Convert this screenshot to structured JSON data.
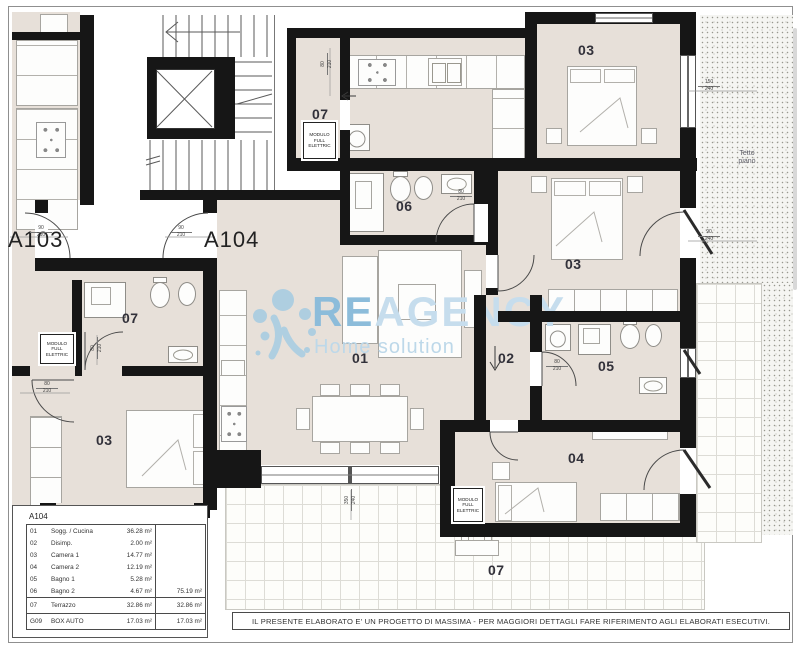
{
  "drawing": {
    "units": {
      "left": "A103",
      "main": "A104"
    },
    "room_labels": {
      "living": "01",
      "disimpegno": "02",
      "camera1": "03",
      "camera_top": "03",
      "camera_a103": "03",
      "camera2": "04",
      "bagno1": "05",
      "bagno2": "06",
      "balcony": "07",
      "bagno_a103": "07",
      "terrazzo": "07"
    },
    "annotations": {
      "tetto_line1": "Tetto",
      "tetto_line2": "piano",
      "modulo": {
        "l1": "MODULO",
        "l2": "FULL",
        "l3": "ELETTRIC"
      }
    },
    "dimensions": {
      "entry_a103": {
        "top": "90",
        "bot": "210"
      },
      "entry_a104": {
        "top": "90",
        "bot": "210"
      },
      "balcony_door": {
        "top": "80",
        "bot": "210"
      },
      "bagno2_door": {
        "top": "80",
        "bot": "210"
      },
      "bagno1_door": {
        "top": "80",
        "bot": "210"
      },
      "camera_a103_door": {
        "top": "80",
        "bot": "210"
      },
      "bagno_a103_door": {
        "top": "80",
        "bot": "210"
      },
      "win_camera_top": {
        "top": "150",
        "bot": "240"
      },
      "door_camera1": {
        "top": "90",
        "bot": "240"
      },
      "win_living": {
        "top": "350",
        "bot": "240"
      }
    }
  },
  "watermark": {
    "brand_bold": "RE",
    "brand_light": "AGENCY",
    "tagline": "Home solution"
  },
  "legend": {
    "title": "A104",
    "rows": [
      {
        "code": "01",
        "name": "Sogg. / Cucina",
        "area": "36.28 m²",
        "total": ""
      },
      {
        "code": "02",
        "name": "Disimp.",
        "area": "2.00 m²",
        "total": ""
      },
      {
        "code": "03",
        "name": "Camera 1",
        "area": "14.77 m²",
        "total": ""
      },
      {
        "code": "04",
        "name": "Camera 2",
        "area": "12.19 m²",
        "total": ""
      },
      {
        "code": "05",
        "name": "Bagno 1",
        "area": "5.28 m²",
        "total": ""
      },
      {
        "code": "06",
        "name": "Bagno 2",
        "area": "4.67 m²",
        "total": "75.19 m²"
      },
      {
        "code": "07",
        "name": "Terrazzo",
        "area": "32.86 m²",
        "total": "32.86 m²"
      },
      {
        "code": "G09",
        "name": "BOX AUTO",
        "area": "17.03 m²",
        "total": "17.03 m²"
      }
    ]
  },
  "disclaimer": "IL PRESENTE ELABORATO E' UN PROGETTO DI MASSIMA - PER MAGGIORI DETTAGLI FARE RIFERIMENTO AGLI ELABORATI ESECUTIVI."
}
